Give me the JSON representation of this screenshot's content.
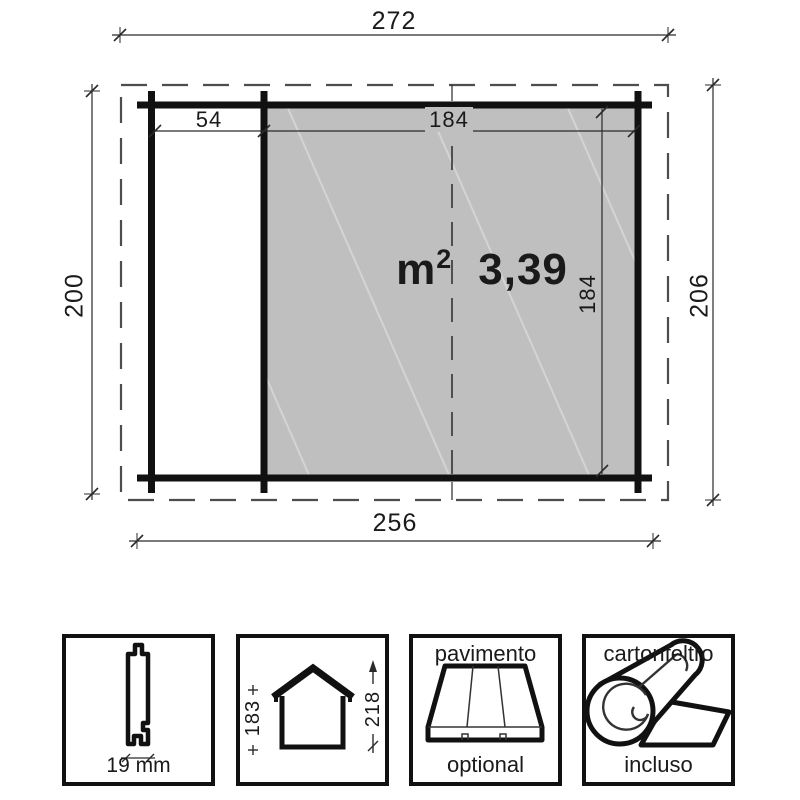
{
  "plan": {
    "dimensions": {
      "overall_width": "272",
      "left_depth": "200",
      "right_depth": "206",
      "base_width": "256",
      "side_width": "54",
      "room_width": "184",
      "room_depth": "184"
    },
    "area": {
      "unit": "m",
      "exponent": "2",
      "value": "3,39"
    }
  },
  "features": {
    "plank": {
      "dim": "19 mm"
    },
    "house": {
      "wall_height": "183",
      "ridge_height": "218"
    },
    "floor": {
      "title": "pavimento",
      "status": "optional"
    },
    "felt": {
      "title": "cartonfeltro",
      "status": "incluso"
    }
  },
  "colors": {
    "floor_fill": "#bfbfbf",
    "line": "#1a1a1a",
    "roof_dash": "#4d4d4d",
    "dimension": "#2a2a2a"
  }
}
